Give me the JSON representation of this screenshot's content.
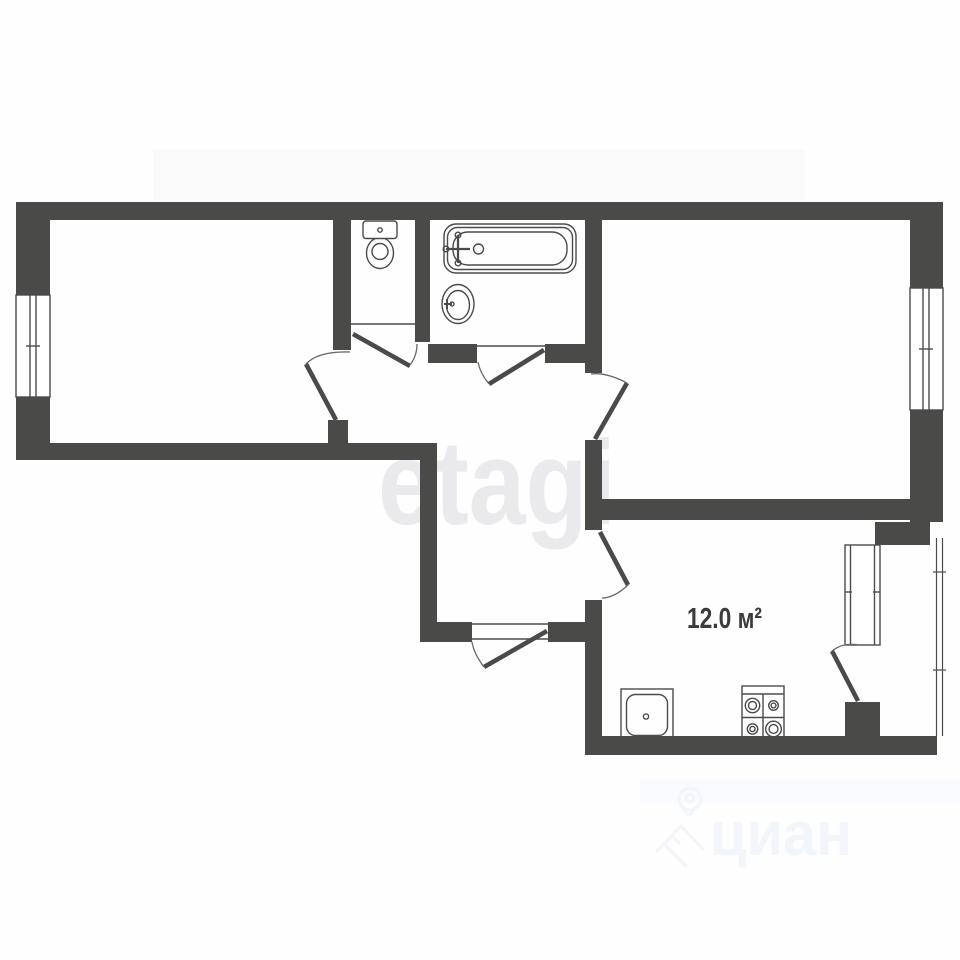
{
  "floorplan": {
    "labels": {
      "kitchen_area": "12.0 м²"
    },
    "watermarks": {
      "etagi": "etagi",
      "cian": "циан"
    },
    "colors": {
      "background": "#fefefe",
      "wall": "#4a4a48",
      "line": "#4b4b4a",
      "arc": "#6a6a68",
      "label": "#3b3b3b",
      "watermark_etagi": "#eaeaed",
      "watermark_cian": "#f2f5f9",
      "artifact_band": "#f7f7f9",
      "artifact_band_bottom": "#f7fafd"
    },
    "fixtures": [
      "toilet-icon",
      "bathtub-icon",
      "washbasin-icon",
      "kitchen-sink-icon",
      "stove-4-burner-icon",
      "cian-house-pin-icon"
    ]
  }
}
